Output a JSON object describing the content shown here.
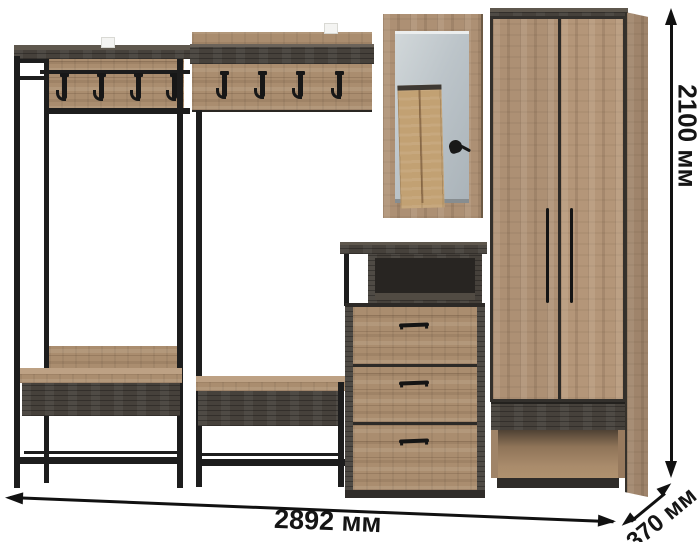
{
  "product": {
    "kind": "hallway-furniture-set-render",
    "background": "#ffffff",
    "parts": [
      "open-coat-rack-with-bench",
      "wall-coat-panel-with-bench",
      "framed-mirror",
      "chest-of-drawers-with-open-shelf",
      "two-door-wardrobe-with-bench-niche"
    ]
  },
  "dimensions": {
    "width_label": "2892 мм",
    "height_label": "2100 мм",
    "depth_label": "370 мм"
  },
  "colors": {
    "wood_light": "#aa8d6f",
    "wood_dark": "#46413b",
    "metal_frame": "#1d1d1d",
    "mirror_glass": "#bcc3c8",
    "annotation_text": "#151515"
  }
}
